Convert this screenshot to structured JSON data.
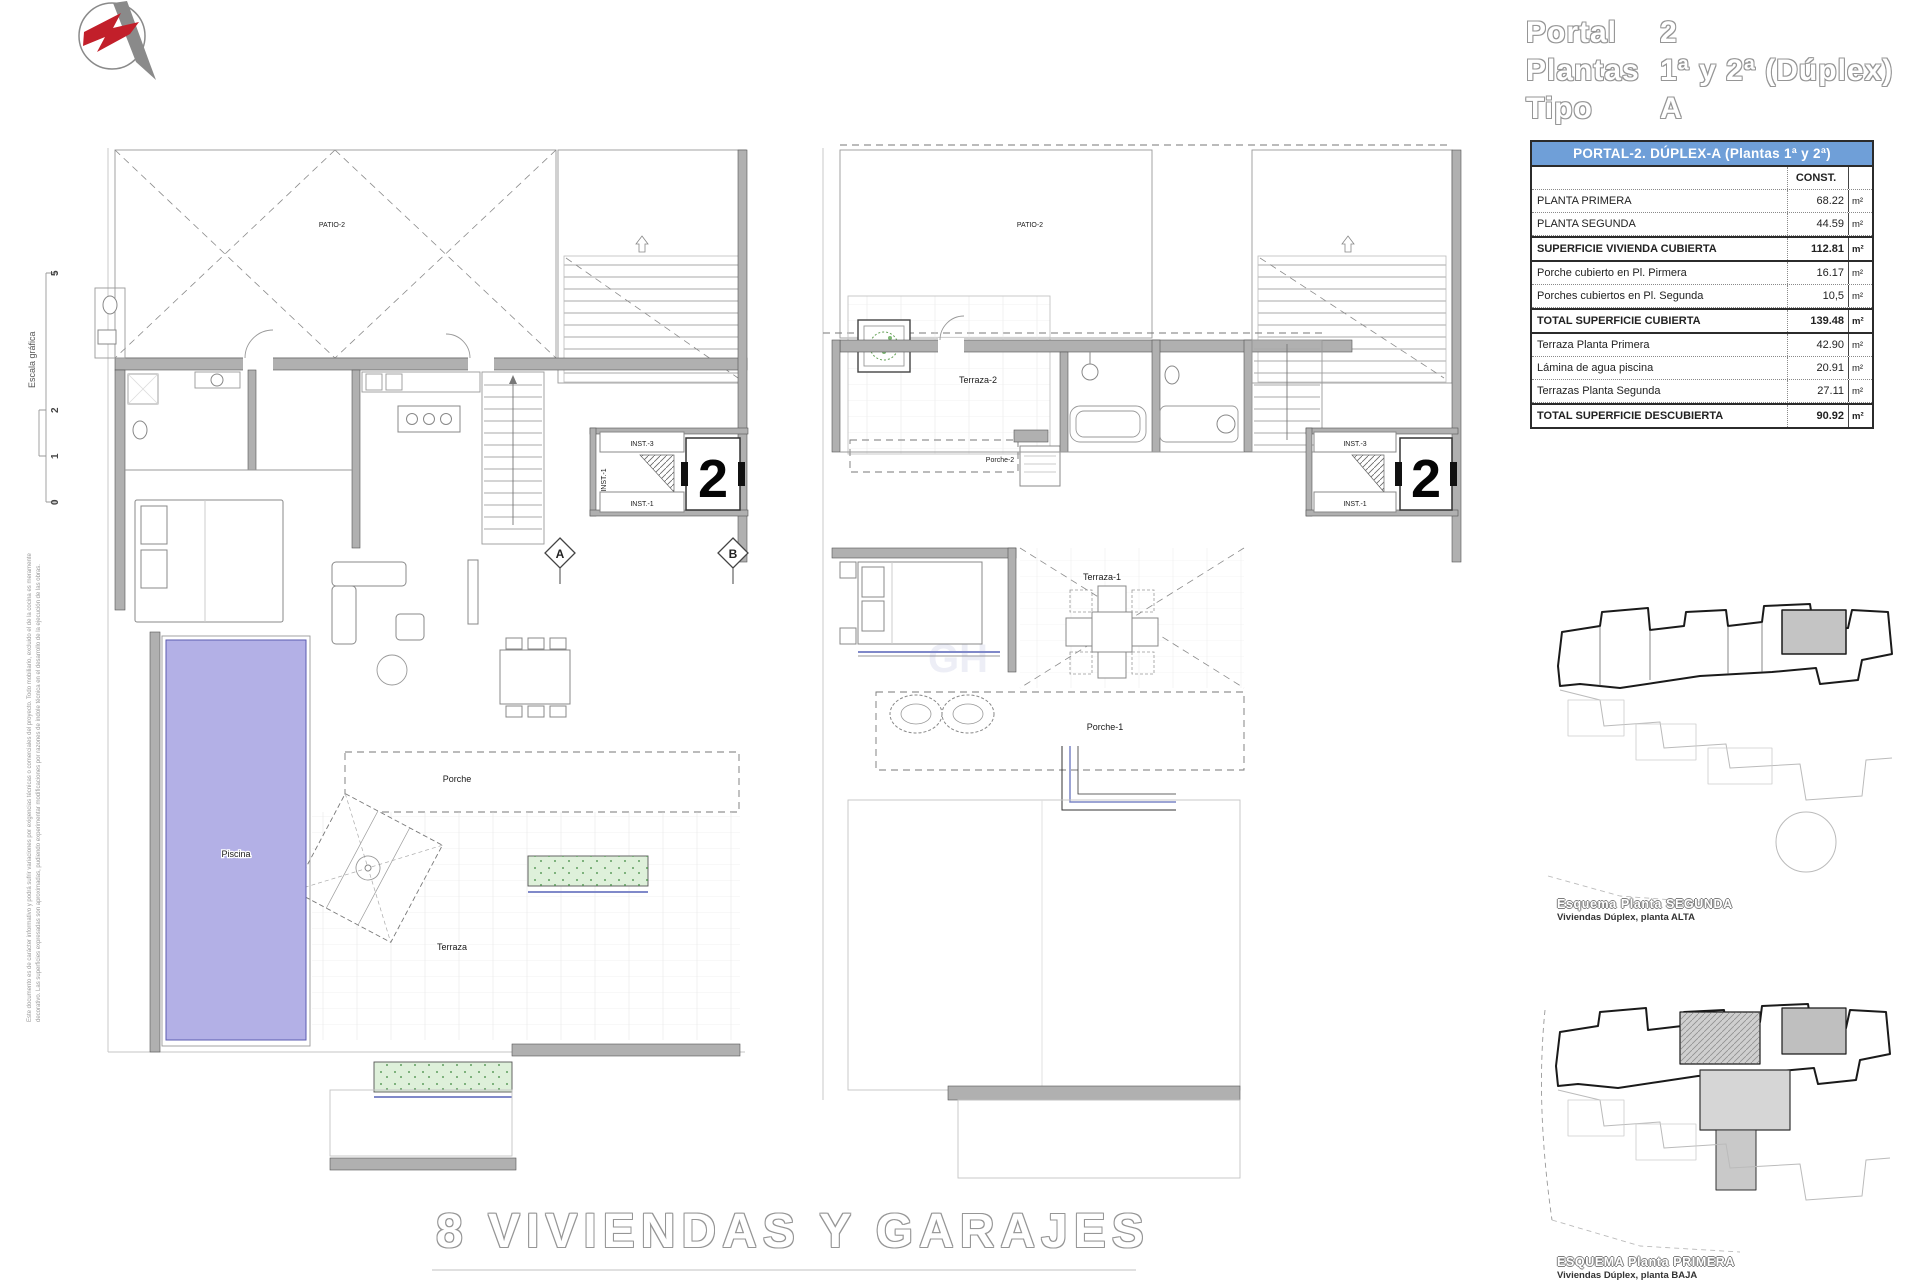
{
  "title_block": {
    "rows": [
      {
        "label": "Portal",
        "value": "2"
      },
      {
        "label": "Plantas",
        "value": "1ª y 2ª (Dúplex)"
      },
      {
        "label": "Tipo",
        "value": "A"
      }
    ]
  },
  "area_table": {
    "title": "PORTAL-2. DÚPLEX-A (Plantas 1ª y 2ª)",
    "col_header": "CONST.",
    "rows": [
      {
        "label": "PLANTA PRIMERA",
        "value": "68.22",
        "unit": "m²"
      },
      {
        "label": "PLANTA SEGUNDA",
        "value": "44.59",
        "unit": "m²"
      },
      {
        "label": "SUPERFICIE VIVIENDA CUBIERTA",
        "value": "112.81",
        "unit": "m²"
      },
      {
        "label": "Porche cubierto en Pl. Pirmera",
        "value": "16.17",
        "unit": "m²"
      },
      {
        "label": "Porches cubiertos en Pl. Segunda",
        "value": "10,5",
        "unit": "m²"
      },
      {
        "label": "TOTAL SUPERFICIE CUBIERTA",
        "value": "139.48",
        "unit": "m²"
      },
      {
        "label": "Terraza Planta Primera",
        "value": "42.90",
        "unit": "m²"
      },
      {
        "label": "Lámina de agua piscina",
        "value": "20.91",
        "unit": "m²"
      },
      {
        "label": "Terrazas Planta Segunda",
        "value": "27.11",
        "unit": "m²"
      },
      {
        "label": "TOTAL SUPERFICIE DESCUBIERTA",
        "value": "90.92",
        "unit": "m²"
      }
    ]
  },
  "scale_bar": {
    "label": "Escala gráfica",
    "ticks": [
      "5",
      "2",
      "1",
      "0"
    ]
  },
  "disclaimer": {
    "line1": "Este documento es de carácter informativo y podrá sufrir variaciones por exigencias técnicas o comerciales del proyecto. Todo mobiliario, excluido el de la cocina es meramente",
    "line2": "decorativo. Las superficies expresadas son aproximadas, pudiendo experimentar modificaciones por razones de índole técnica en el desarrollo de la ejecución de las obras."
  },
  "plan_left": {
    "labels": {
      "patio": "PATIO-2",
      "porche": "Porche",
      "terraza": "Terraza",
      "piscina": "Piscina",
      "inst_top": "INST.-3",
      "inst_side": "INST.-1",
      "inst_bottom": "INST.-1",
      "unit_number": "2",
      "section_a": "A",
      "section_b": "B"
    }
  },
  "plan_right": {
    "labels": {
      "patio": "PATIO-2",
      "terraza2": "Terraza-2",
      "porche2": "Porche-2",
      "terraza1": "Terraza-1",
      "porche1": "Porche-1",
      "inst_top": "INST.-3",
      "inst_bottom": "INST.-1",
      "unit_number": "2"
    }
  },
  "site_diagrams": {
    "upper": {
      "title": "Esquema Planta SEGUNDA",
      "subtitle": "Viviendas Dúplex, planta ALTA"
    },
    "lower": {
      "title": "ESQUEMA Planta PRIMERA",
      "subtitle": "Viviendas Dúplex, planta BAJA"
    }
  },
  "footer": {
    "title": "8 VIVIENDAS Y GARAJES"
  },
  "colors": {
    "pool": "#b3b0e6",
    "planter": "#def0da",
    "table_header_bg": "#6f9fd8",
    "wall": "#b0b0b0",
    "accent_red": "#c21f2a",
    "blue_line": "#8089c9"
  }
}
